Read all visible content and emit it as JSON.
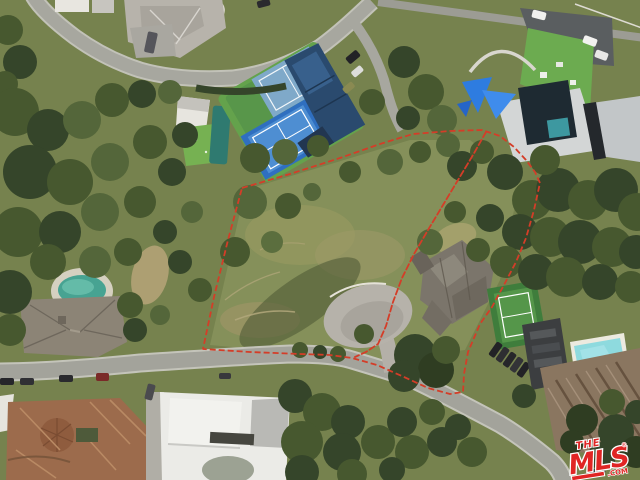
{
  "image": {
    "kind": "real-estate aerial photograph",
    "width": 640,
    "height": 480
  },
  "watermark": {
    "the": "THE",
    "mls": "MLS",
    "reg": "®",
    "com": ".COM",
    "color": "#e02524",
    "outline": "#ffffff"
  },
  "boundary": {
    "color": "#d43d28",
    "outer": "242,188 290,174 340,158 380,144 413,134 450,131 482,130 500,136 514,147 526,160 535,172 540,183 534,210 526,238 516,262 505,283 492,307 480,324 468,352 464,374 463,392 450,394 428,388 404,377 377,365 352,358 330,355 300,354 250,352 203,349 214,297 228,240",
    "divider": "486,132 473,155 458,180 443,205 428,230 414,254 402,278 393,302 386,326 378,344 366,352 355,357"
  },
  "palette": {
    "hillside": "#85905a",
    "trees_dark": "#35452a",
    "trees_mid": "#47583 2",
    "road": "#a3a39b",
    "tennis_blue": "#2f6fc0",
    "pool_teal": "#3aa695",
    "estate_pool": "#8edade",
    "tile_roof": "#9c6b4c"
  }
}
